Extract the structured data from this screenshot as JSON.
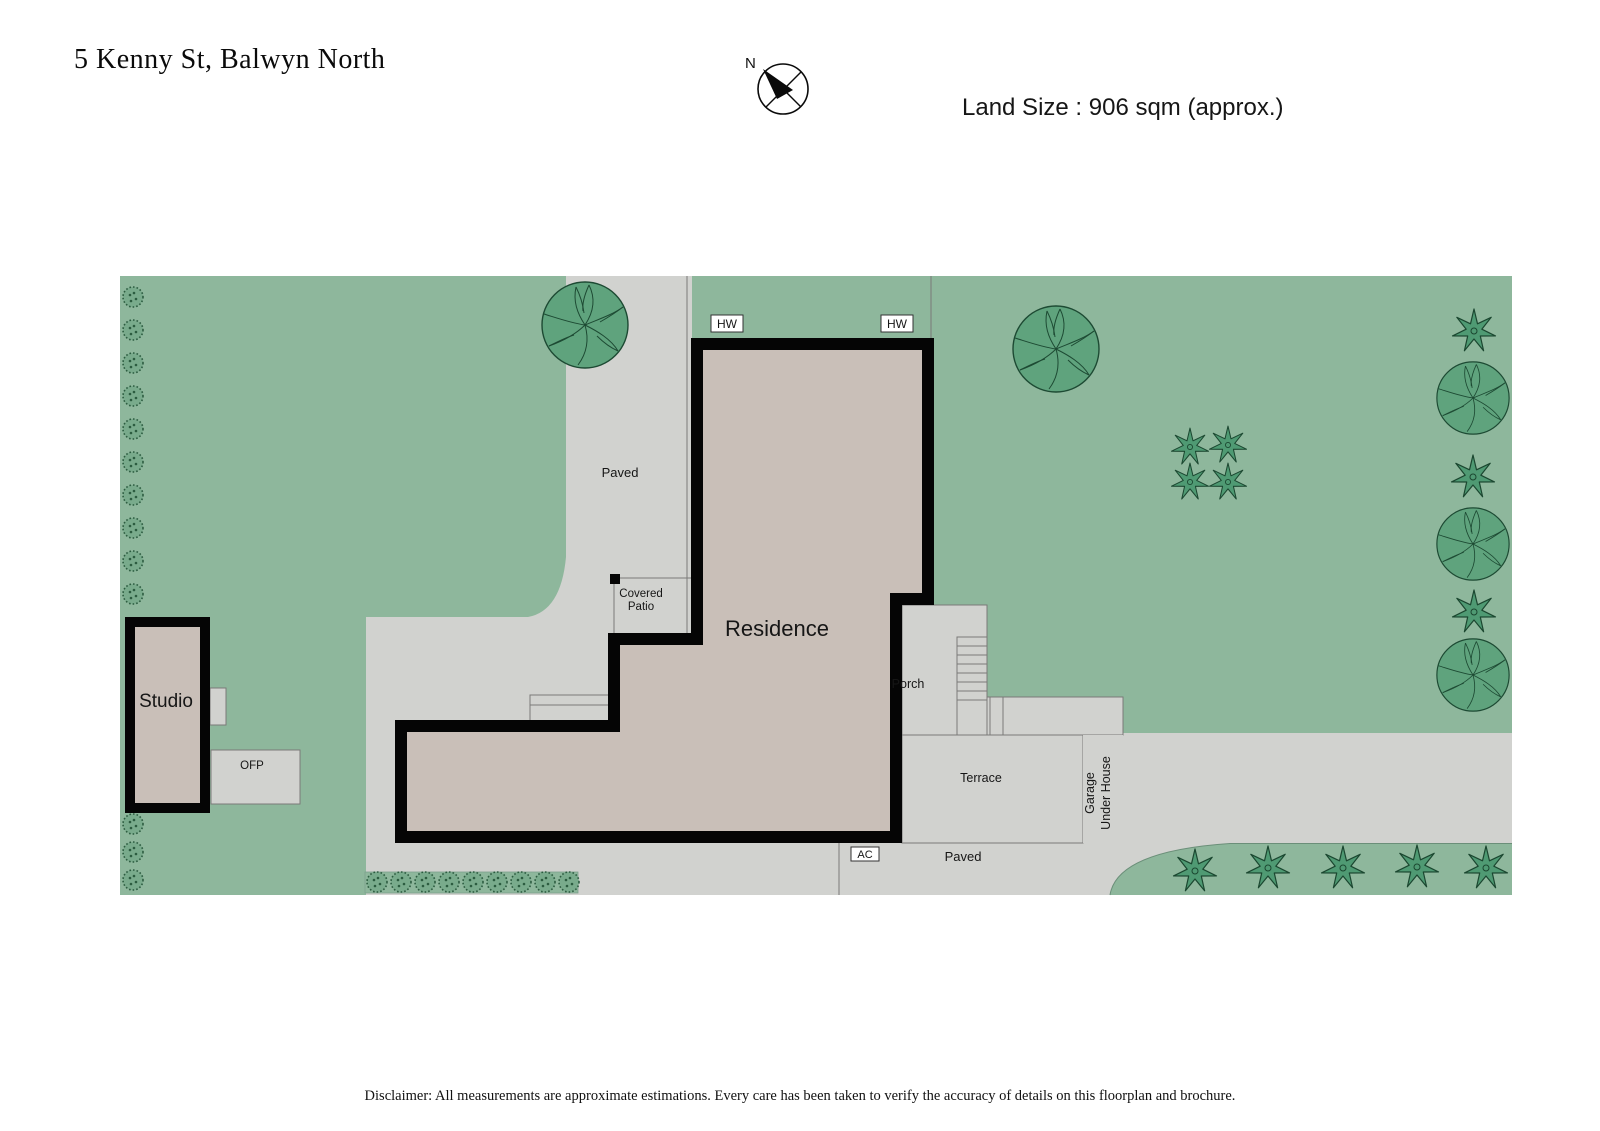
{
  "header": {
    "address": "5 Kenny St, Balwyn North",
    "land_size": "Land Size : 906 sqm (approx.)",
    "compass_north": "N"
  },
  "plan": {
    "labels": {
      "paved_driveway": "Paved",
      "residence": "Residence",
      "covered_patio_line1": "Covered",
      "covered_patio_line2": "Patio",
      "porch": "Porch",
      "terrace": "Terrace",
      "garage_line1": "Garage",
      "garage_line2": "Under House",
      "paved_bottom": "Paved",
      "studio": "Studio",
      "ofp": "OFP",
      "hw_left": "HW",
      "hw_right": "HW",
      "ac": "AC"
    },
    "colors": {
      "lawn": "#8eb79c",
      "paving": "#d1d2cf",
      "building": "#c9bfb8",
      "wall": "#050505",
      "tree_fill": "#5fa37d",
      "tree_outline": "#1d4a33",
      "star_fill": "#4f9a73",
      "shrub_dot": "#2c5c40"
    }
  },
  "footer": {
    "disclaimer": "Disclaimer: All measurements are approximate estimations. Every care has been taken to verify the accuracy of details on this floorplan and brochure."
  }
}
